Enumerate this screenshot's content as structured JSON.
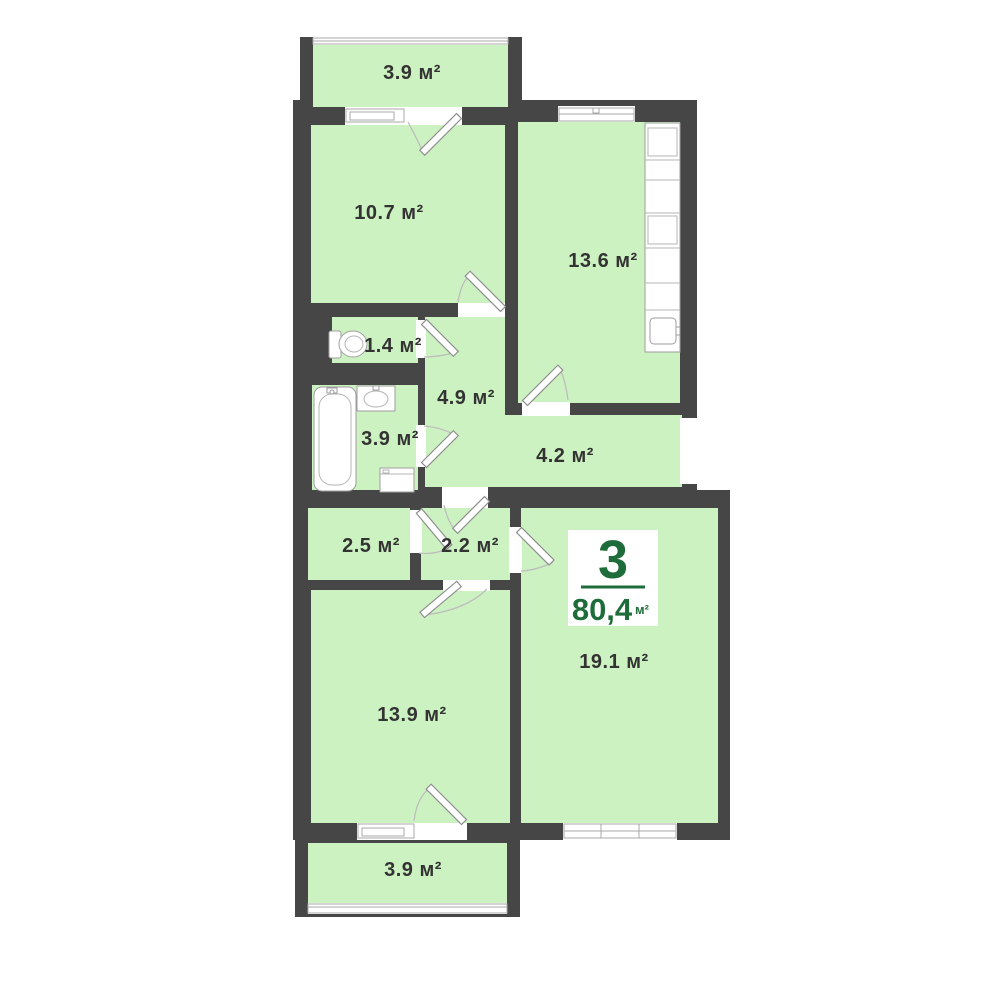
{
  "floorplan": {
    "badge": {
      "number": "3",
      "total_area": "80,4",
      "unit": "м²"
    },
    "rooms": {
      "balcony_top": {
        "area": "3.9 м²"
      },
      "bedroom_1": {
        "area": "10.7 м²"
      },
      "kitchen": {
        "area": "13.6 м²"
      },
      "wc": {
        "area": "1.4 м²"
      },
      "hallway": {
        "area": "4.9 м²"
      },
      "bathroom": {
        "area": "3.9 м²"
      },
      "corridor": {
        "area": "4.2 м²"
      },
      "storage": {
        "area": "2.5 м²"
      },
      "hall": {
        "area": "2.2 м²"
      },
      "living_room": {
        "area": "19.1 м²"
      },
      "bedroom_2": {
        "area": "13.9 м²"
      },
      "balcony_bottom": {
        "area": "3.9 м²"
      }
    },
    "colors": {
      "wall": "#464646",
      "room": "#cdf2c1",
      "accent": "#1d6c3a"
    }
  }
}
